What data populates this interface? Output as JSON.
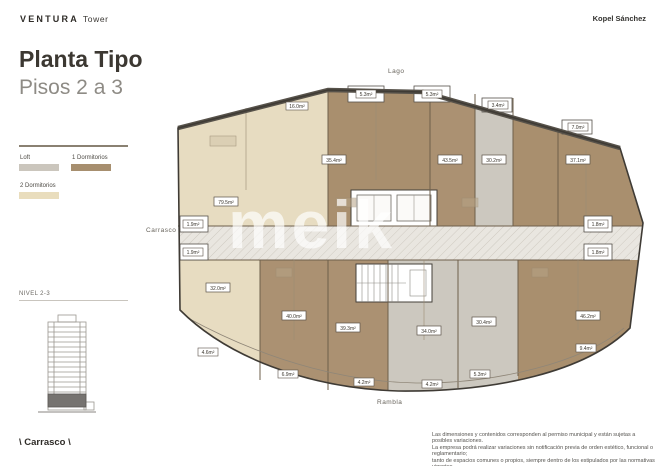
{
  "header": {
    "brand": "VENTURA",
    "brand_suffix": "Tower",
    "studio": "Kopel Sánchez"
  },
  "sidebar": {
    "title_line1": "Planta Tipo",
    "title_line2": "Pisos 2 a 3",
    "legend": {
      "loft_label": "Loft",
      "one_dorm_label": "1 Dormitorios",
      "two_dorm_label": "2 Dormitorios"
    },
    "colors": {
      "loft": "#cbc6bd",
      "one_dorm": "#a78f6f",
      "two_dorm": "#e9ddbd"
    },
    "level_label": "NIVEL 2-3",
    "street_label": "\\ Carrasco \\"
  },
  "plan": {
    "orientation": {
      "top": "Lago",
      "left": "Carrasco",
      "right": "Al Este",
      "bottom": "Rambla"
    },
    "watermark": "meik",
    "areas": {
      "u79": "79.5m²",
      "u32": "32.0m²",
      "u35": "35.4m²",
      "u43": "43.5m²",
      "u30_2": "30.2m²",
      "u37": "37.1m²",
      "u40": "40.0m²",
      "u39": "39.3m²",
      "u34": "34.0m²",
      "u30_4": "30.4m²",
      "u46": "46.2m²",
      "b16": "16.0m²",
      "b53a": "5.3m²",
      "b53b": "5.3m²",
      "b34": "3.4m²",
      "b70": "7.0m²",
      "b19a": "1.9m²",
      "b19b": "1.9m²",
      "b18a": "1.8m²",
      "b18b": "1.8m²",
      "b46": "4.6m²",
      "b69": "6.9m²",
      "b42a": "4.2m²",
      "b42b": "4.2m²",
      "b53c": "5.3m²",
      "b94": "9.4m²"
    }
  },
  "footer": {
    "disclaimer_lines": [
      "Las dimensiones y contenidos corresponden al permiso municipal y están sujetas a posibles variaciones.",
      "La empresa podrá realizar variaciones sin notificación previa de orden estético, funcional o reglamentario;",
      "tanto de espacios comunes o propios, siempre dentro de los estipulados por las normativas vigentes.",
      "El equipamiento es indicativo y se representa en los gráficos solo a título informativo."
    ]
  }
}
